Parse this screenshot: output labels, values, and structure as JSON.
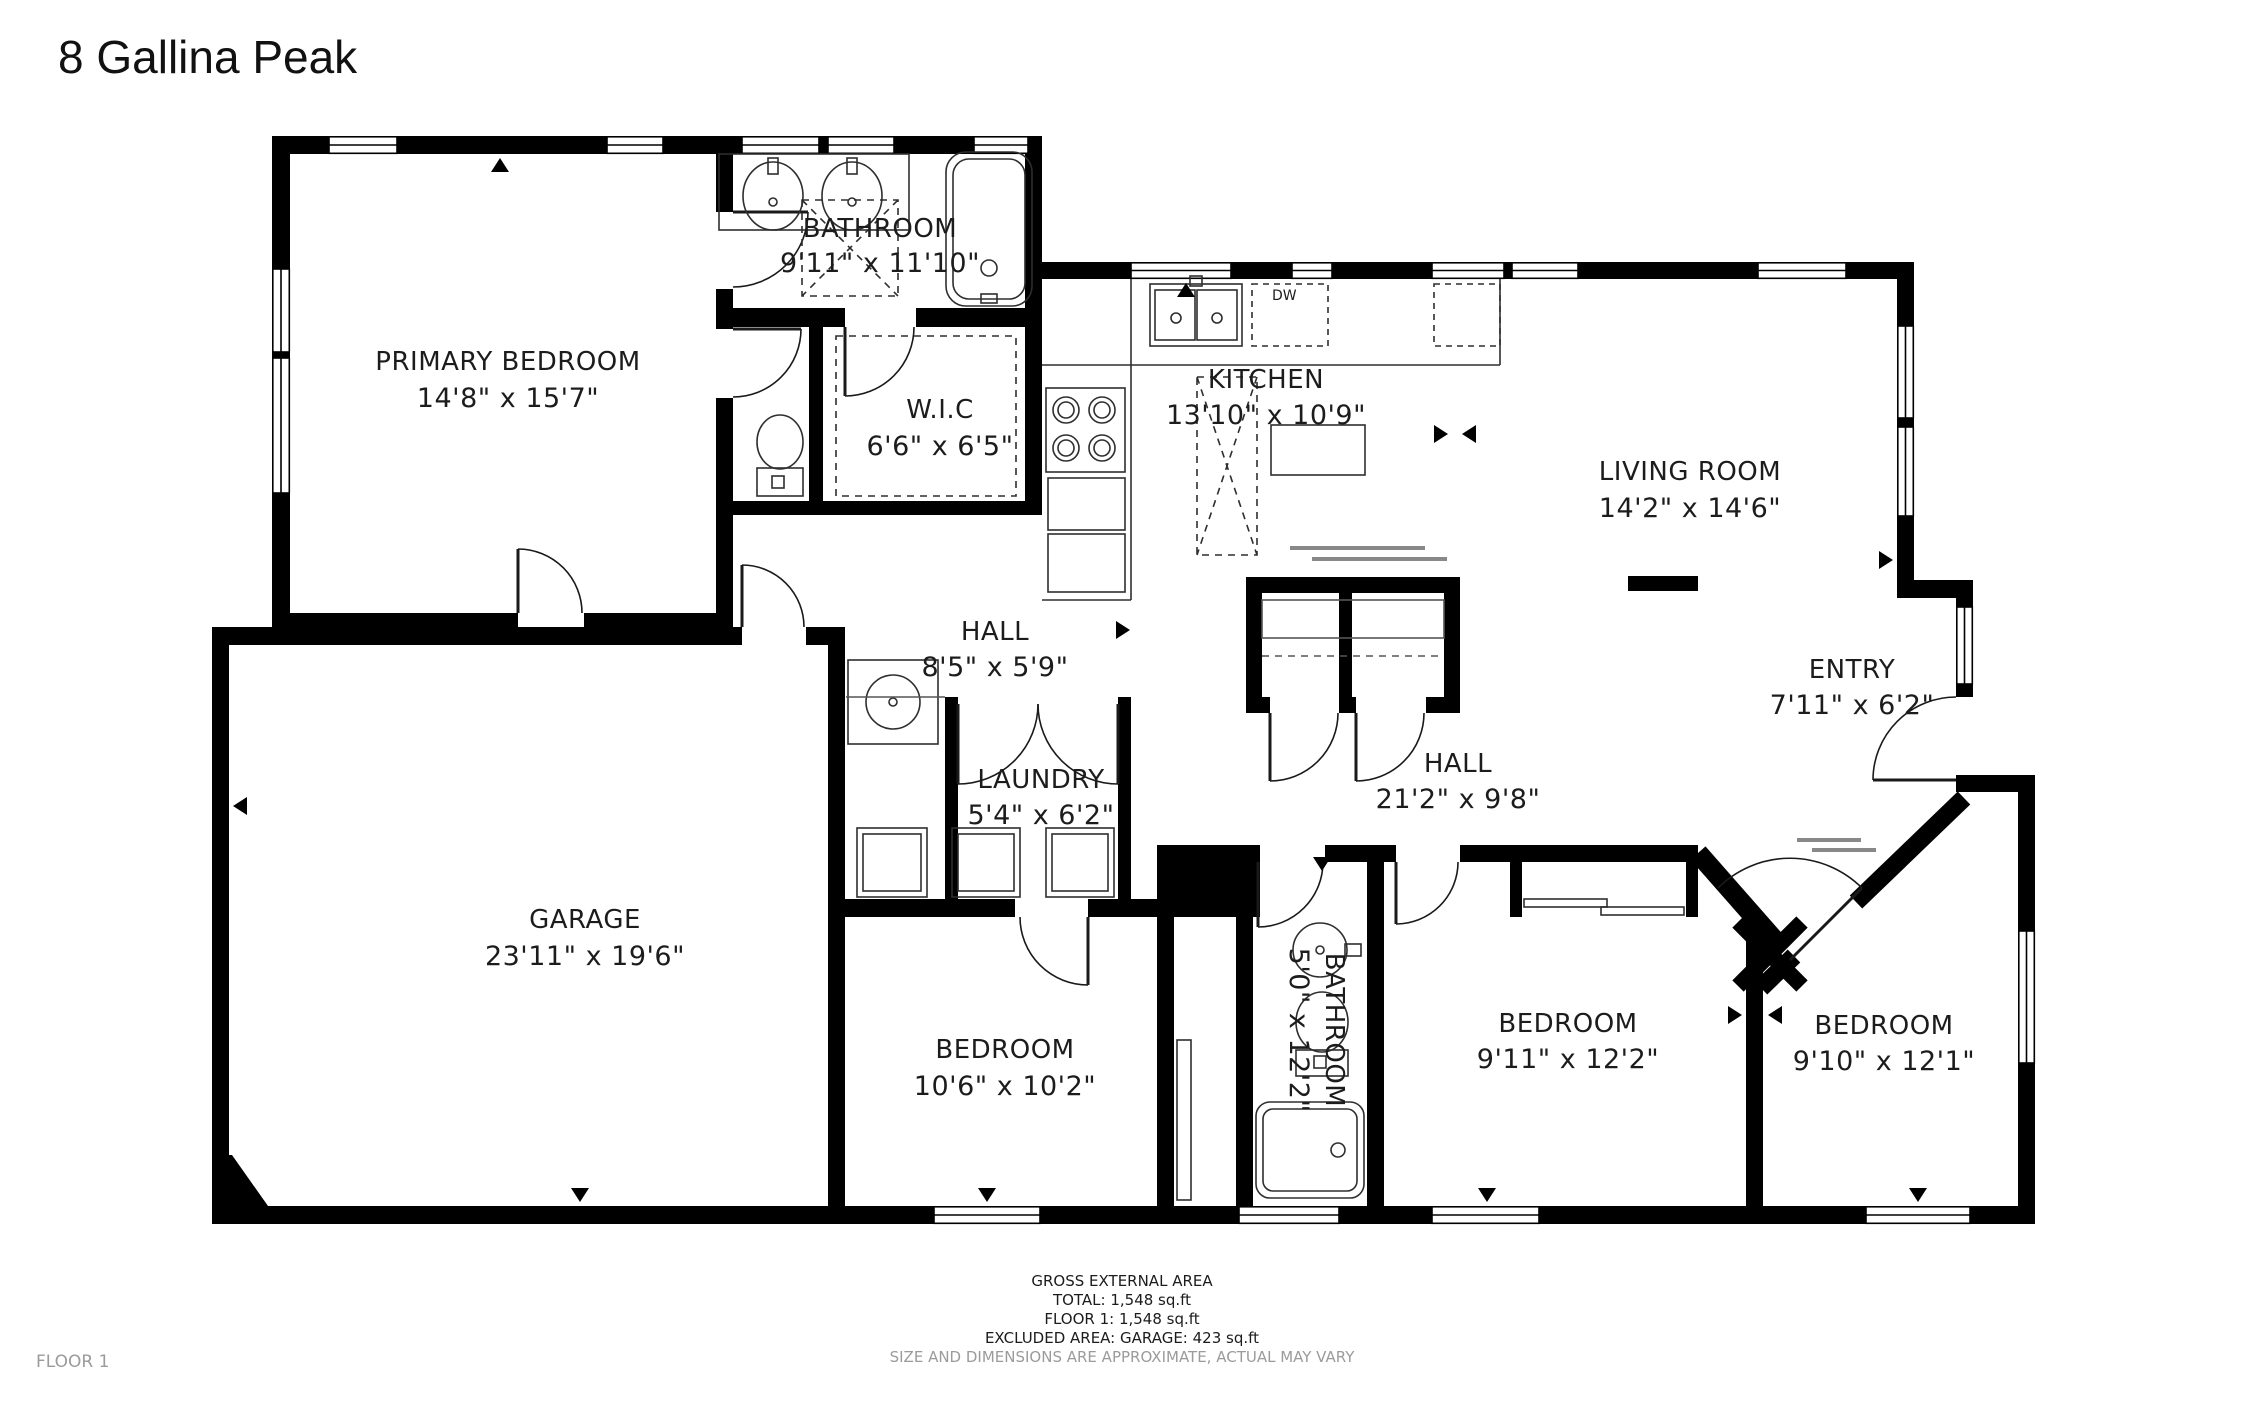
{
  "title": "8 Gallina Peak",
  "floor_label": "FLOOR 1",
  "rooms": {
    "primary_bedroom": {
      "name": "PRIMARY BEDROOM",
      "dims": "14'8\" x 15'7\""
    },
    "bathroom_main": {
      "name": "BATHROOM",
      "dims": "9'11\" x 11'10\""
    },
    "wic": {
      "name": "W.I.C",
      "dims": "6'6\" x 6'5\""
    },
    "kitchen": {
      "name": "KITCHEN",
      "dims": "13'10\" x 10'9\""
    },
    "living_room": {
      "name": "LIVING ROOM",
      "dims": "14'2\" x 14'6\""
    },
    "hall_small": {
      "name": "HALL",
      "dims": "8'5\" x 5'9\""
    },
    "entry": {
      "name": "ENTRY",
      "dims": "7'11\" x 6'2\""
    },
    "hall_large": {
      "name": "HALL",
      "dims": "21'2\" x 9'8\""
    },
    "laundry": {
      "name": "LAUNDRY",
      "dims": "5'4\" x 6'2\""
    },
    "garage": {
      "name": "GARAGE",
      "dims": "23'11\" x 19'6\""
    },
    "bedroom_mid": {
      "name": "BEDROOM",
      "dims": "10'6\" x 10'2\""
    },
    "bathroom_small": {
      "name": "BATHROOM",
      "dims": "5'0\" x 12'2\""
    },
    "bedroom_right": {
      "name": "BEDROOM",
      "dims": "9'11\" x 12'2\""
    },
    "bedroom_far_right": {
      "name": "BEDROOM",
      "dims": "9'10\" x 12'1\""
    }
  },
  "appliances": {
    "dishwasher": "DW"
  },
  "footer": {
    "line1": "GROSS EXTERNAL AREA",
    "line2": "TOTAL: 1,548 sq.ft",
    "line3": "FLOOR 1: 1,548 sq.ft",
    "line4": "EXCLUDED AREA: GARAGE: 423 sq.ft",
    "disclaimer": "SIZE AND DIMENSIONS ARE APPROXIMATE, ACTUAL MAY VARY"
  },
  "colors": {
    "wall": "#000000",
    "text": "#1c1c1c",
    "muted": "#9b9b9b"
  }
}
